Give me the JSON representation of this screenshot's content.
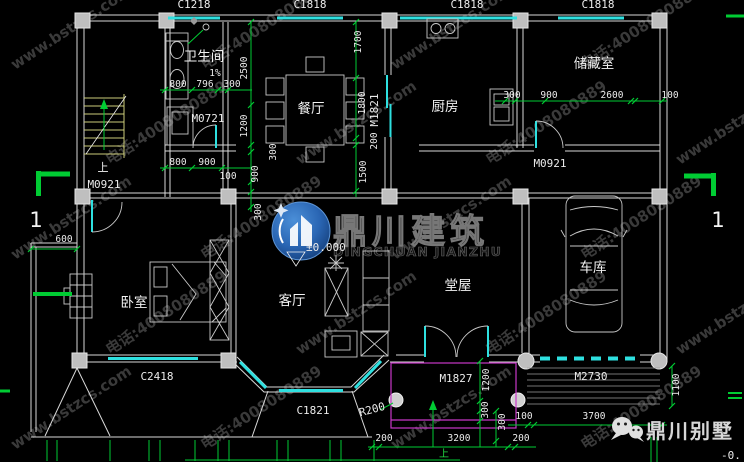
{
  "colors": {
    "background": "#000000",
    "dimension_green": "#00cc33",
    "window_cyan": "#2ee0e0",
    "wall_white": "#d9d9d9",
    "column_gray": "#bfbfbf",
    "porch_magenta": "#c837c8",
    "stair_yellow": "#cdcd7a",
    "watermark_gray": "#3a3a3a",
    "logo_blue": "#2e6fc0"
  },
  "watermark": {
    "url": "www.bstzcs.com",
    "phone": "电话:4008080889",
    "logo_cn": "鼎川建筑",
    "logo_en": "DINGCHUAN JIANZHU",
    "brand": "鼎川别墅"
  },
  "rooms": {
    "bathroom": "卫生间",
    "dining": "餐厅",
    "kitchen": "厨房",
    "storage": "储藏室",
    "bedroom": "卧室",
    "living": "客厅",
    "hall": "堂屋",
    "garage": "车库"
  },
  "openings": {
    "top_windows": [
      "C1218",
      "C1818",
      "C1818",
      "C1818"
    ],
    "m0721": "M0721",
    "m0921_stairs": "M0921",
    "m0921_storage": "M0921",
    "m1821": "M1821",
    "m1827": "M1827",
    "m2730": "M2730",
    "c2418": "C2418",
    "c1821": "C1821",
    "r200": "R200"
  },
  "dims": {
    "bath_top": [
      "800",
      "796",
      "300"
    ],
    "bath_bottom": [
      "800",
      "900",
      "100"
    ],
    "left_chain": [
      "2500",
      "1200",
      "300",
      "900",
      "300"
    ],
    "right_chain": [
      "1700",
      "1800",
      "200",
      "1500"
    ],
    "storage_chain": [
      "300",
      "900",
      "2600",
      "100"
    ],
    "west": "600",
    "porch_v": [
      "1200",
      "300",
      "300"
    ],
    "drive_chain": [
      "100",
      "3700"
    ],
    "ramp": "1100",
    "bottom_chain": [
      "200",
      "3200",
      "200"
    ],
    "slope": "1%"
  },
  "axis": {
    "left": "1",
    "right": "1"
  },
  "levels": {
    "ground": "±0.000",
    "corner": "-0."
  },
  "annotations": {
    "up_stairs": "上",
    "up_porch": "上"
  }
}
